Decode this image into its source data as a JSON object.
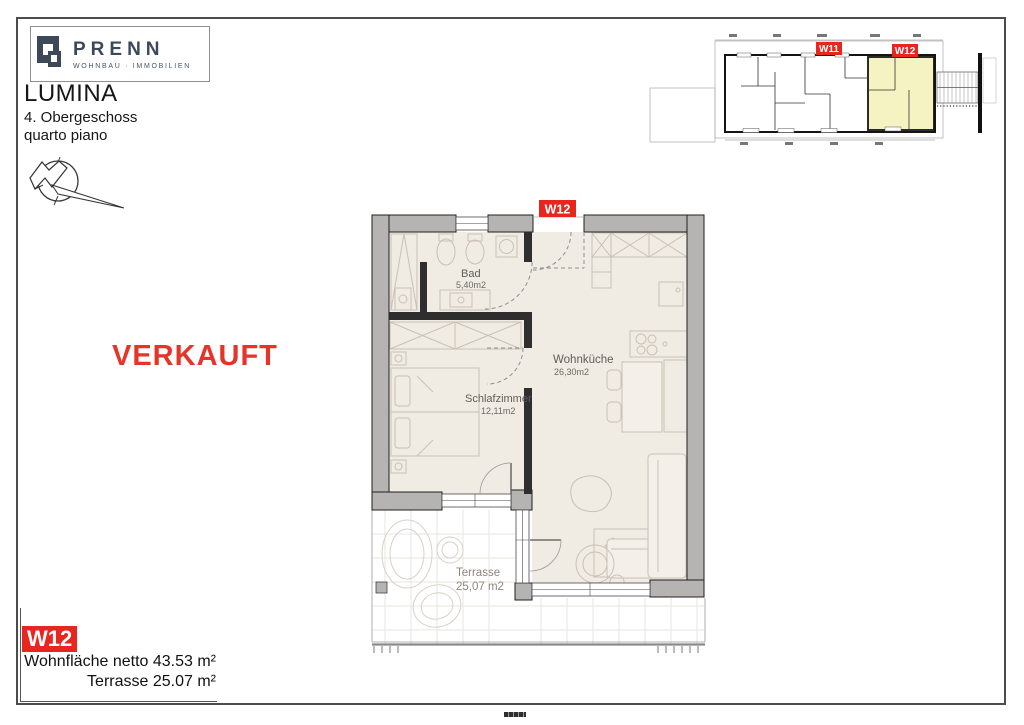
{
  "header": {
    "logo": {
      "brand": "PRENN",
      "subtitle": "WOHNBAU · IMMOBILIEN"
    },
    "project": "LUMINA",
    "floor_de": "4. Obergeschoss",
    "floor_it": "quarto piano"
  },
  "stamp": {
    "text": "VERKAUFT"
  },
  "overview": {
    "units": [
      {
        "label": "W11"
      },
      {
        "label": "W12"
      }
    ],
    "highlight_color": "#F6F3C3"
  },
  "plan": {
    "unit_label": "W12",
    "rooms": {
      "bad": {
        "name": "Bad",
        "area": "5,40m2"
      },
      "schlafzimmer": {
        "name": "Schlafzimmer",
        "area": "12,11m2"
      },
      "wohnkueche": {
        "name": "Wohnküche",
        "area": "26,30m2"
      },
      "terrasse": {
        "name": "Terrasse",
        "area": "25,07 m2"
      }
    }
  },
  "titleblock": {
    "unit": "W12",
    "area_label": "Wohnfläche netto",
    "area_value": "43.53 m²",
    "terrace_label": "Terrasse",
    "terrace_value": "25.07 m²"
  },
  "colors": {
    "accent_red": "#E7271F",
    "brand_navy": "#3D4959",
    "wall_gray": "#B5B4B2",
    "floor_beige": "#F0EBE3",
    "highlight_yellow": "#F6F3C3"
  }
}
